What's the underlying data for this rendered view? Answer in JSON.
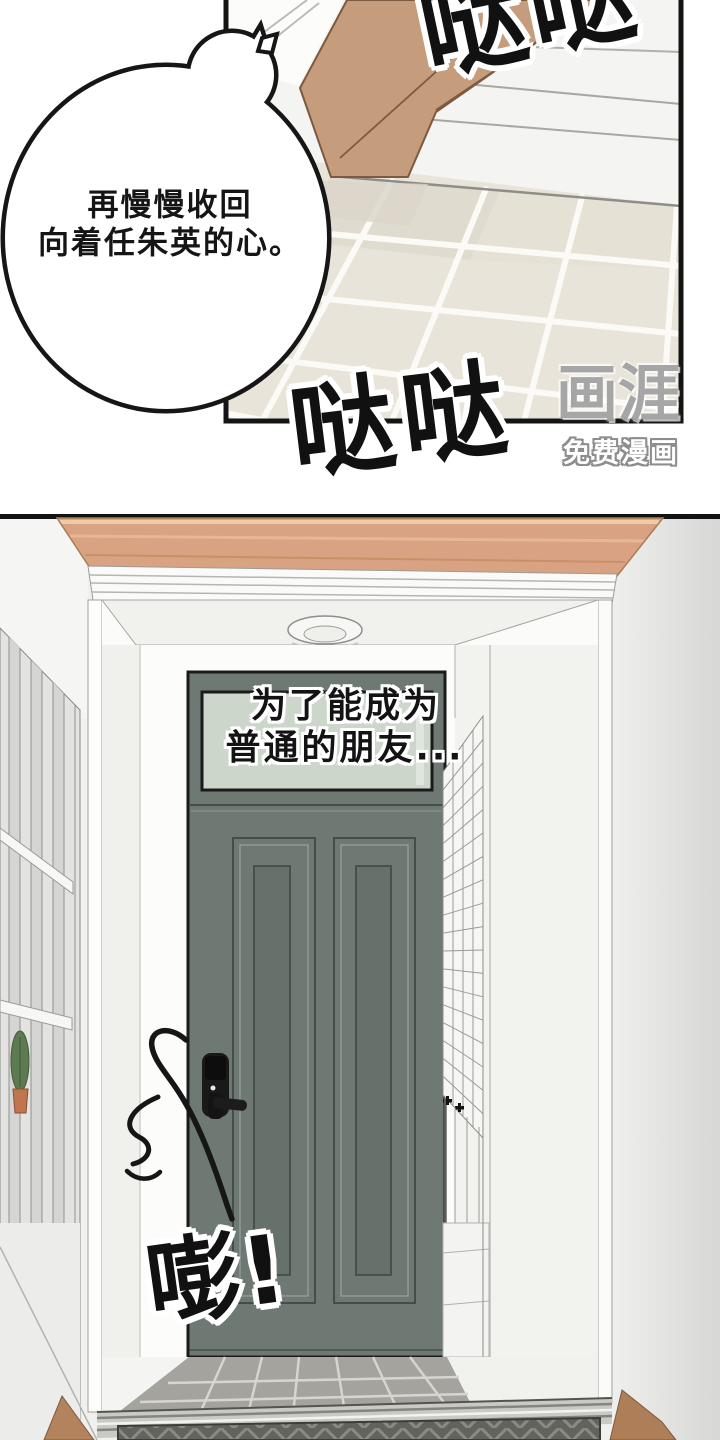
{
  "panel1": {
    "speech_bubble": {
      "line1": "再慢慢收回",
      "line2": "向着任朱英的心。"
    },
    "sfx_top": "哒哒",
    "sfx_bottom": "哒哒"
  },
  "panel2": {
    "caption": {
      "line1": "为了能成为",
      "line2": "普通的朋友..."
    },
    "sfx_door": "嘭!"
  },
  "watermark": {
    "logo": "画涯",
    "tagline": "免费漫画"
  },
  "colors": {
    "panel_border": "#141414",
    "wood_leg": "#c59c7c",
    "floor_tile_beige": "#e9e4d9",
    "ceiling_trim_wood": "#d8a283",
    "door_gray_green": "#6f7974",
    "transom_glass": "#ccd6cb",
    "entry_tile_gray": "#a4a39e",
    "doormat": "#63635e",
    "flower_pot": "#c0754e"
  }
}
